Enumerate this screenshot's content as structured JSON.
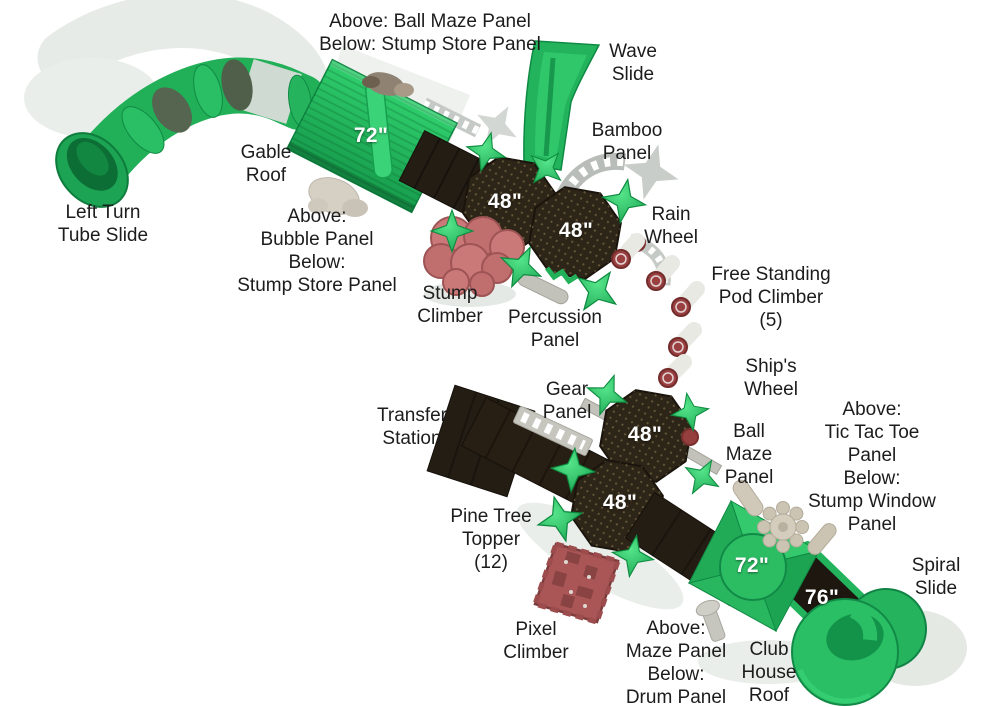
{
  "diagram": {
    "title": "Playground structure top view with labeled components",
    "background": "#ffffff",
    "colors": {
      "green": "#22b25a",
      "green_bright": "#3bd377",
      "green_dark": "#0f8a44",
      "deck_dark": "#241d14",
      "octagon_dark": "#2d2517",
      "stump_pink": "#c97878",
      "pixel_red": "#aa5656",
      "pod_red": "#9a4040",
      "tan": "#ccc4b3",
      "shadow_gray": "#dfe3df",
      "label_text": "#1c1c1c",
      "size_text": "#ffffff"
    },
    "deck_sizes": [
      {
        "id": "gable-roof-size",
        "text": "72\""
      },
      {
        "id": "upper-deck-1-size",
        "text": "48\""
      },
      {
        "id": "upper-deck-2-size",
        "text": "48\""
      },
      {
        "id": "lower-deck-1-size",
        "text": "48\""
      },
      {
        "id": "lower-deck-2-size",
        "text": "48\""
      },
      {
        "id": "club-roof-size",
        "text": "72\""
      },
      {
        "id": "ramp-size",
        "text": "76\""
      }
    ],
    "labels": [
      {
        "id": "ball-maze-stump-store",
        "lines": [
          "Above: Ball Maze Panel",
          "Below: Stump Store Panel"
        ]
      },
      {
        "id": "wave-slide",
        "lines": [
          "Wave",
          "Slide"
        ]
      },
      {
        "id": "bamboo-panel",
        "lines": [
          "Bamboo",
          "Panel"
        ]
      },
      {
        "id": "gable-roof",
        "lines": [
          "Gable",
          "Roof"
        ]
      },
      {
        "id": "left-turn-tube-slide",
        "lines": [
          "Left Turn",
          "Tube Slide"
        ]
      },
      {
        "id": "bubble-panel",
        "lines": [
          "Above:",
          "Bubble Panel",
          "Below:",
          "Stump Store Panel"
        ]
      },
      {
        "id": "rain-wheel",
        "lines": [
          "Rain",
          "Wheel"
        ]
      },
      {
        "id": "stump-climber",
        "lines": [
          "Stump",
          "Climber"
        ]
      },
      {
        "id": "percussion-panel",
        "lines": [
          "Percussion",
          "Panel"
        ]
      },
      {
        "id": "free-standing-pod-climber",
        "lines": [
          "Free Standing",
          "Pod Climber",
          "(5)"
        ]
      },
      {
        "id": "ships-wheel",
        "lines": [
          "Ship's",
          "Wheel"
        ]
      },
      {
        "id": "gear-panel",
        "lines": [
          "Gear",
          "Panel"
        ]
      },
      {
        "id": "transfer-station",
        "lines": [
          "Transfer",
          "Station"
        ]
      },
      {
        "id": "ball-maze-panel",
        "lines": [
          "Ball",
          "Maze",
          "Panel"
        ]
      },
      {
        "id": "tic-tac-toe",
        "lines": [
          "Above:",
          "Tic Tac Toe",
          "Panel",
          "Below:",
          "Stump Window",
          "Panel"
        ]
      },
      {
        "id": "pine-tree-topper",
        "lines": [
          "Pine Tree",
          "Topper",
          "(12)"
        ]
      },
      {
        "id": "pixel-climber",
        "lines": [
          "Pixel",
          "Climber"
        ]
      },
      {
        "id": "maze-drum",
        "lines": [
          "Above:",
          "Maze Panel",
          "Below:",
          "Drum Panel"
        ]
      },
      {
        "id": "club-house-roof",
        "lines": [
          "Club",
          "House",
          "Roof"
        ]
      },
      {
        "id": "spiral-slide",
        "lines": [
          "Spiral",
          "Slide"
        ]
      }
    ]
  }
}
